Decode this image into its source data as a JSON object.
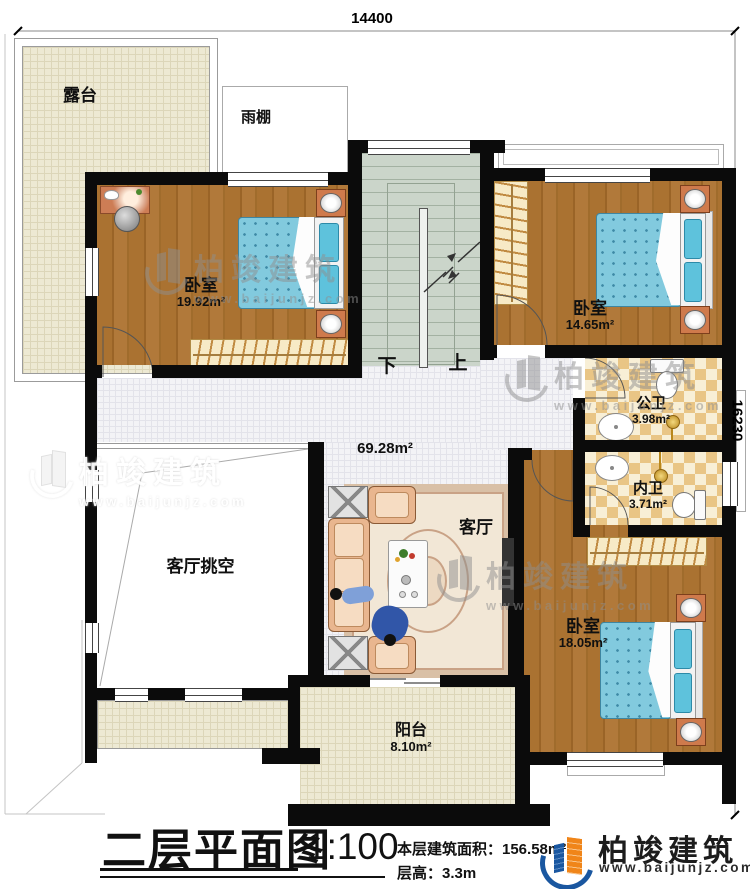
{
  "dimensions": {
    "top": "14400",
    "right": "16230"
  },
  "rooms": {
    "terrace": {
      "label": "露台"
    },
    "canopy": {
      "label": "雨棚"
    },
    "bedroom1": {
      "label": "卧室",
      "area": "19.92m²"
    },
    "bedroom2": {
      "label": "卧室",
      "area": "14.65m²"
    },
    "bedroom3": {
      "label": "卧室",
      "area": "18.05m²"
    },
    "public_bath": {
      "label": "公卫",
      "area": "3.98m²"
    },
    "inner_bath": {
      "label": "内卫",
      "area": "3.71m²"
    },
    "living": {
      "label": "客厅",
      "area": "69.28m²"
    },
    "void": {
      "label": "客厅挑空"
    },
    "balcony": {
      "label": "阳台",
      "area": "8.10m²"
    }
  },
  "stairs": {
    "down": "下",
    "up": "上"
  },
  "watermark": {
    "brand": "柏竣建筑",
    "site": "www.baijunjz.com"
  },
  "titleblock": {
    "title": "二层平面图",
    "scale": "1:100",
    "area_line": "本层建筑面积：156.58m²",
    "height_line": "层高：3.3m",
    "brand": "柏竣建筑",
    "site": "www.baijunjz.com"
  },
  "colors": {
    "wall": "#0b0b0b",
    "wood": "#a9712f",
    "checker_tan": "#e9c585",
    "stair_green": "#cbd5ca",
    "bed_blue": "#82cade",
    "logo_blue": "#1a57a0",
    "logo_orange": "#f08519"
  }
}
